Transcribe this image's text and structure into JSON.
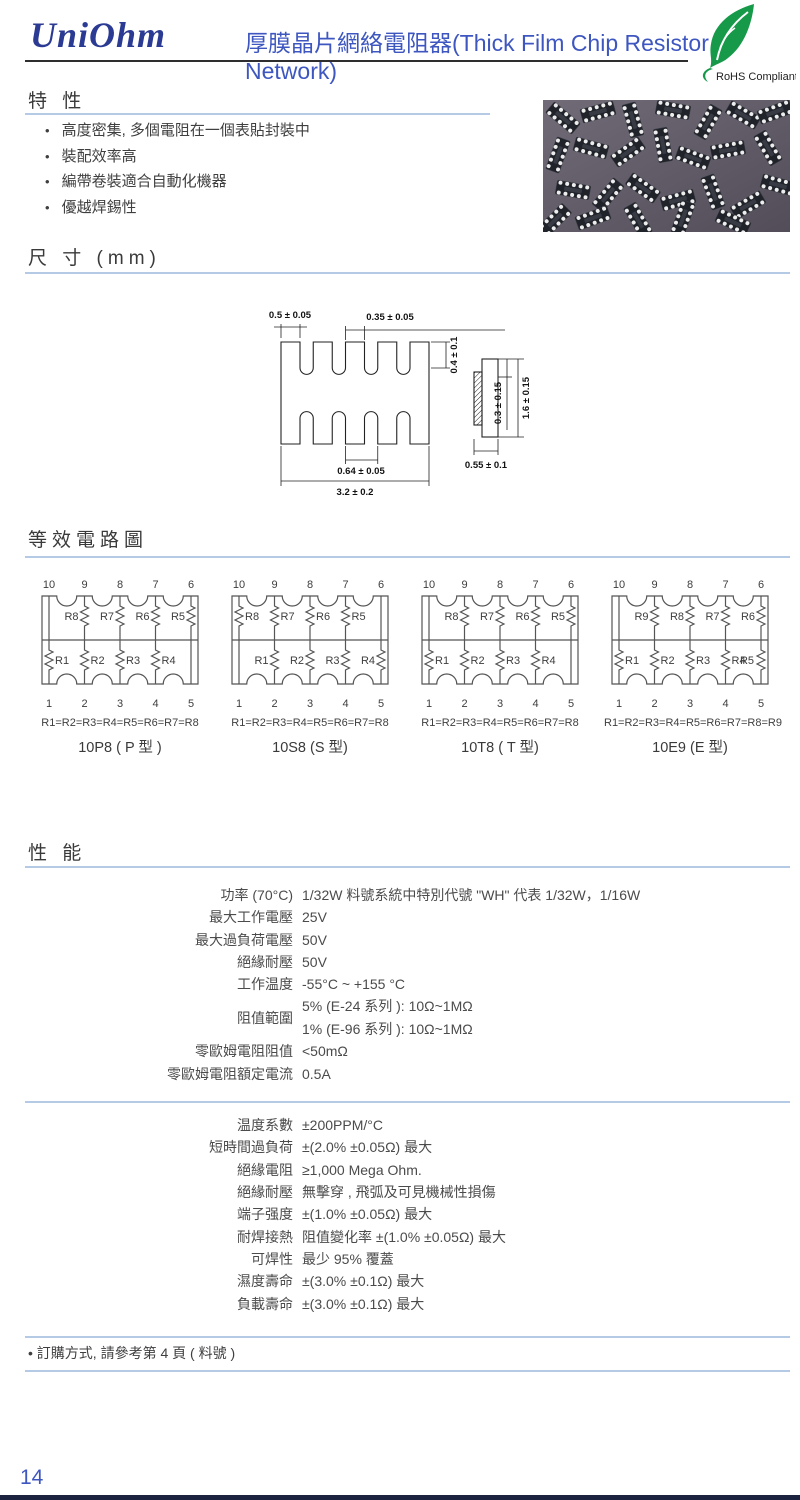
{
  "header": {
    "logo": "UniOhm",
    "title": "厚膜晶片網絡電阻器(Thick Film Chip Resistor Network)",
    "rohs_label": "RoHS Compliant"
  },
  "features": {
    "heading": "特 性",
    "items": [
      "高度密集, 多個電阻在一個表貼封裝中",
      "裝配效率高",
      "編帶卷裝適合自動化機器",
      "優越焊錫性"
    ]
  },
  "dimensions": {
    "heading": "尺 寸 (mm)",
    "labels": {
      "pad_end": "0.5 ± 0.05",
      "pad_width": "0.35 ± 0.05",
      "pad_height": "0.4 ± 0.1",
      "pitch": "0.64 ± 0.05",
      "length": "3.2 ± 0.2",
      "electrode": "0.3 ± 0.15",
      "width": "1.6 ± 0.15",
      "thickness": "0.55 ± 0.1"
    }
  },
  "circuits": {
    "heading": "等效電路圖",
    "pins_top": [
      "10",
      "9",
      "8",
      "7",
      "6"
    ],
    "pins_bottom": [
      "1",
      "2",
      "3",
      "4",
      "5"
    ],
    "diagrams": [
      {
        "top_resistors": [
          "R8",
          "R7",
          "R6",
          "R5"
        ],
        "bottom_resistors": [
          "R1",
          "R2",
          "R3",
          "R4"
        ],
        "formula": "R1=R2=R3=R4=R5=R6=R7=R8",
        "caption": "10P8 ( P 型 )"
      },
      {
        "top_resistors": [
          "R8",
          "R7",
          "R6",
          "R5"
        ],
        "bottom_resistors": [
          "R1",
          "R2",
          "R3",
          "R4"
        ],
        "formula": "R1=R2=R3=R4=R5=R6=R7=R8",
        "caption": "10S8 (S 型)"
      },
      {
        "top_resistors": [
          "R8",
          "R7",
          "R6",
          "R5"
        ],
        "bottom_resistors": [
          "R1",
          "R2",
          "R3",
          "R4"
        ],
        "formula": "R1=R2=R3=R4=R5=R6=R7=R8",
        "caption": "10T8 ( T 型)"
      },
      {
        "top_resistors": [
          "R9",
          "R8",
          "R7",
          "R6"
        ],
        "bottom_resistors": [
          "R1",
          "R2",
          "R3",
          "R4",
          "R5"
        ],
        "formula": "R1=R2=R3=R4=R5=R6=R7=R8=R9",
        "caption": "10E9  (E 型)"
      }
    ]
  },
  "performance": {
    "heading": "性 能",
    "specs": [
      {
        "label": "功率 (70°C)",
        "value": "1/32W 料號系統中特別代號 \"WH\" 代表 1/32W，1/16W"
      },
      {
        "label": "最大工作電壓",
        "value": "25V"
      },
      {
        "label": "最大過負荷電壓",
        "value": "50V"
      },
      {
        "label": "絕緣耐壓",
        "value": "50V"
      },
      {
        "label": "工作温度",
        "value": "-55°C ~ +155 °C"
      },
      {
        "label": "阻值範圍",
        "value_line1": "5% (E-24 系列 ): 10Ω~1MΩ",
        "value_line2": "1% (E-96 系列 ): 10Ω~1MΩ"
      },
      {
        "label": "零歐姆電阻阻值",
        "value": "<50mΩ"
      },
      {
        "label": "零歐姆電阻額定電流",
        "value": "0.5A"
      }
    ],
    "specs2": [
      {
        "label": "温度系數",
        "value": "±200PPM/°C"
      },
      {
        "label": "短時間過負荷",
        "value": "±(2.0% ±0.05Ω) 最大"
      },
      {
        "label": "絕緣電阻",
        "value": "≥1,000 Mega Ohm."
      },
      {
        "label": "絕緣耐壓",
        "value": "無擊穿 , 飛弧及可見機械性損傷"
      },
      {
        "label": "端子强度",
        "value": "±(1.0% ±0.05Ω) 最大"
      },
      {
        "label": "耐焊接熱",
        "value": "阻值變化率 ±(1.0% ±0.05Ω) 最大"
      },
      {
        "label": "可焊性",
        "value": "最少 95% 覆蓋"
      },
      {
        "label": "濕度壽命",
        "value": "±(3.0% ±0.1Ω) 最大"
      },
      {
        "label": "負載壽命",
        "value": "±(3.0% ±0.1Ω) 最大"
      }
    ]
  },
  "footer": {
    "note": "• 訂購方式, 請參考第 4 頁 ( 料號 )",
    "page_number": "14"
  },
  "colors": {
    "title_blue": "#3d56c0",
    "logo_navy": "#2b3a92",
    "underline_blue": "#b5cbe5",
    "rohs_green": "#17994a",
    "bottom_bar": "#1b2340"
  }
}
